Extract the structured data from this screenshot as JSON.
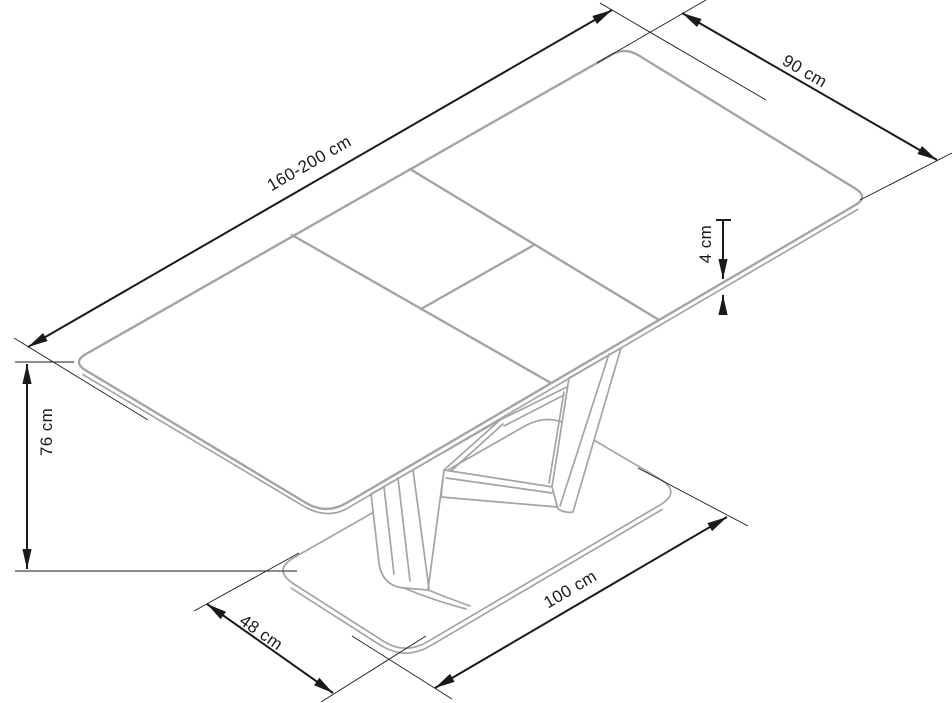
{
  "diagram": {
    "title": "extendable-table-dimension-drawing",
    "object": "Extendable dining table with split extension leaf, V-shaped pedestal column and rounded base plate",
    "view": "isometric line drawing with dimension arrows",
    "units": "cm",
    "dimensions": {
      "length": {
        "label": "160-200 cm",
        "value": "160-200",
        "measures": "table top length (extended range)"
      },
      "width": {
        "label": "90 cm",
        "value": "90",
        "measures": "table top width"
      },
      "top_thickness": {
        "label": "4 cm",
        "value": "4",
        "measures": "table top thickness"
      },
      "height": {
        "label": "76 cm",
        "value": "76",
        "measures": "table height"
      },
      "base_width": {
        "label": "48 cm",
        "value": "48",
        "measures": "base plate width"
      },
      "base_length": {
        "label": "100 cm",
        "value": "100",
        "measures": "base plate length"
      }
    },
    "colors": {
      "object_outline": "#a4a4a4",
      "dimension_lines": "#1a1a1a",
      "background": "#ffffff"
    }
  }
}
